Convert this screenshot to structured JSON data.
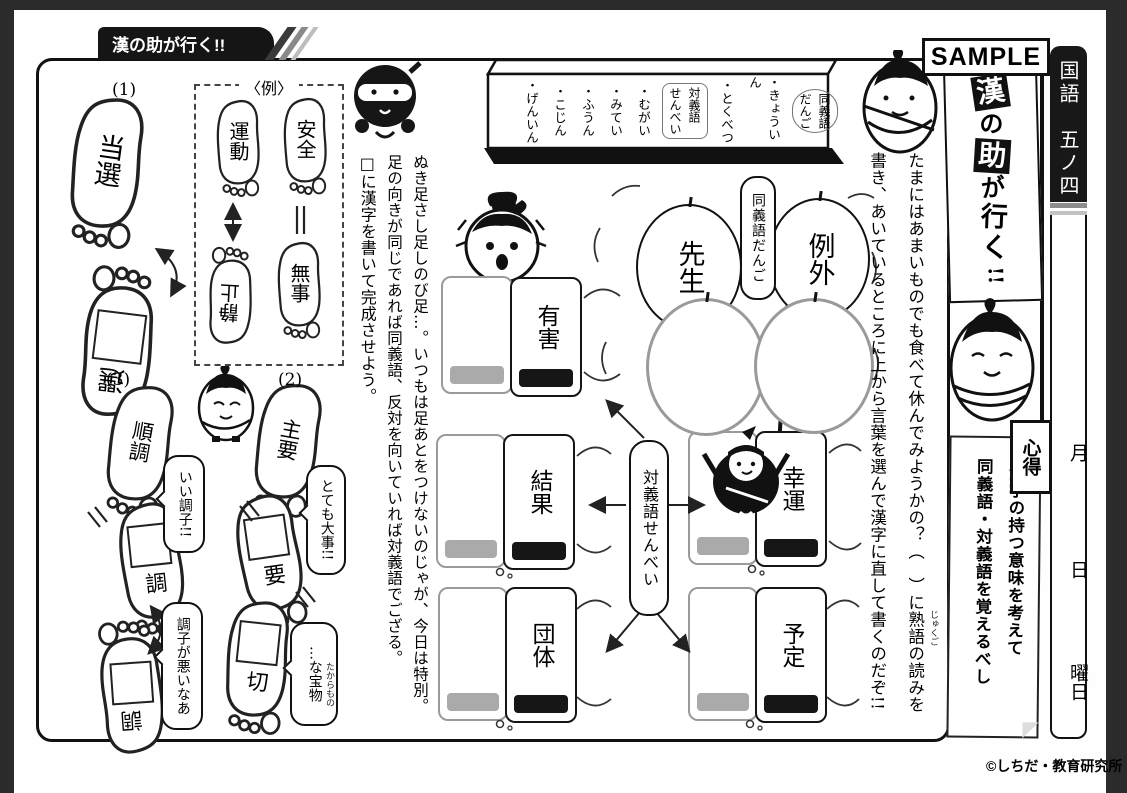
{
  "colors": {
    "ink": "#1a1a1a",
    "gray_outline": "#9a9a9a",
    "page": "#ffffff",
    "backdrop": "#2b2b2b"
  },
  "header": {
    "tab": "漢の助が行く!!",
    "sample": "SAMPLE",
    "subject": "国語　五ノ四"
  },
  "banner": {
    "chars": [
      "漢",
      "の",
      "助",
      "が",
      "行",
      "く",
      "!!"
    ]
  },
  "date": {
    "month": "月",
    "day": "日",
    "weekday": "曜日"
  },
  "copyright": "©しちだ・教育研究所",
  "signboard": {
    "label_syn": {
      "l1": "同義語",
      "l2": "だんご"
    },
    "syn_items": [
      "・きょういん",
      "・とくべつ"
    ],
    "label_ant": {
      "l1": "対義語",
      "l2": "せんべい"
    },
    "ant_items": [
      "・むがい",
      "・みてい",
      "・ふうん",
      "・こじん",
      "・げんいん"
    ]
  },
  "instructions_left": {
    "col1": "ぬき足さし足しのび足…。いつもは足あとをつけないのじゃが、今日は特別。",
    "col2": "足の向きが同じであれば同義語、反対を向いていれば対義語でござる。",
    "col3": "□に漢字を書いて完成させよう。"
  },
  "instructions_right": {
    "col1": "たまにはあまいものでも食べて休んでみようかの？（　）に熟語の読みを",
    "col2": "書き、あいているところに上から言葉を選んで漢字に直して書くのだぞ!!",
    "furigana": "じゅくご"
  },
  "example": {
    "label": "〈例〉",
    "pair_arrow": {
      "top": "運動",
      "bottom": "静止"
    },
    "pair_equal": {
      "top": "安全",
      "bottom": "無事"
    }
  },
  "problems": {
    "p1": {
      "num": "(1)",
      "given": "当選",
      "answer": "選"
    },
    "p2": {
      "num": "(2)",
      "given": "主要",
      "ans1": "要",
      "ans2": "切",
      "bubble1": "とても大事!!",
      "bubble2": "…な宝物",
      "furigana": "たからもの"
    },
    "p3": {
      "num": "(3)",
      "given": "順調",
      "ans1": "調",
      "ans2": "調",
      "bubble1": "いい調子!!",
      "bubble2": "調子が悪いなあ"
    }
  },
  "dango": {
    "label": "同義語だんご",
    "ball1": "先生",
    "ball2": "例外"
  },
  "senbei": {
    "label": "対義語せんべい",
    "cards": {
      "c0": "有害",
      "c1": "結果",
      "c2": "幸運",
      "c3": "団体",
      "c4": "予定"
    }
  },
  "kokoroe": {
    "label": "心得",
    "line1": "漢字の持つ意味を考えて",
    "line2": "同義語・対義語を覚えるべし"
  }
}
